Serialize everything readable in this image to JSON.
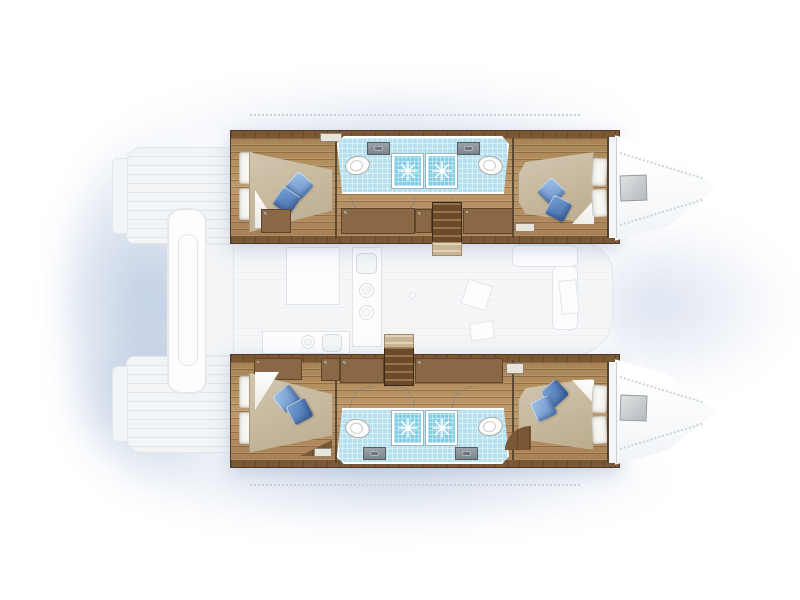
{
  "title": "Catamaran floor plan — top view, 4-cabin / 4-bathroom layout",
  "boat": {
    "type": "sailing catamaran deck & cabin plan",
    "orientation": {
      "bow": "right",
      "stern": "left",
      "port_hull": "top",
      "starboard_hull": "bottom"
    }
  },
  "palette": {
    "wood": "#b2895c",
    "wood_dark": "#7a5836",
    "bath_floor": "#b7e0ee",
    "shower": "#84cde3",
    "fixture_white": "#fbfbf9",
    "mattress_beige": "#c7b89d",
    "cushion_blue_light": "#6a93cb",
    "cushion_blue_dark": "#4772b0",
    "ghost_gray": "#f2f4f6",
    "shadow_blue": "#9fb4d4",
    "hatch_gray": "#c3c7c9"
  },
  "hulls": [
    {
      "name": "port hull (top)",
      "rooms": [
        {
          "name": "aft double cabin",
          "items": [
            "double bed",
            "2 white pillows",
            "blue cushion light",
            "blue cushion dark",
            "locker"
          ]
        },
        {
          "name": "aft bathroom",
          "items": [
            "washbasin",
            "toilet",
            "shower"
          ]
        },
        {
          "name": "forward bathroom",
          "items": [
            "shower",
            "washbasin",
            "toilet"
          ]
        },
        {
          "name": "forward double cabin",
          "items": [
            "double bed",
            "2 white pillows",
            "blue cushion light",
            "blue cushion dark"
          ]
        },
        {
          "name": "bow locker",
          "items": [
            "deck hatch"
          ]
        }
      ],
      "features": [
        "companionway stairs",
        "hanging lockers",
        "door swing arcs",
        "vents"
      ]
    },
    {
      "name": "starboard hull (bottom)",
      "rooms": [
        {
          "name": "aft double cabin",
          "items": [
            "double bed",
            "2 white pillows",
            "blue cushion light",
            "blue cushion dark",
            "bench"
          ]
        },
        {
          "name": "aft bathroom",
          "items": [
            "toilet",
            "washbasin",
            "shower"
          ]
        },
        {
          "name": "forward bathroom",
          "items": [
            "shower",
            "toilet",
            "washbasin"
          ]
        },
        {
          "name": "forward double cabin",
          "items": [
            "double bed",
            "2 white pillows",
            "blue cushion light",
            "blue cushion dark",
            "step platform"
          ]
        },
        {
          "name": "bow locker",
          "items": [
            "deck hatch"
          ]
        }
      ],
      "features": [
        "companionway stairs",
        "hanging lockers",
        "drawer unit",
        "door swing arcs",
        "vents"
      ]
    }
  ],
  "deck_ghost": {
    "features": [
      "aft swim platforms",
      "transom steps",
      "dinghy on davit platform",
      "bridgedeck",
      "saloon",
      "galley counter with sink and two burners",
      "aft galley counter with sink and burner",
      "dining sofa",
      "saloon table",
      "lounge cushions",
      "mast foot",
      "side deck lifelines",
      "deck hatches"
    ]
  },
  "icons": {
    "shower-spray-icon": "white starburst in shower tray",
    "hanger-icon": "vertical strokes in locker cells",
    "door-swing-icon": "dashed quarter-circle arc",
    "vent-icon": "three dark slots",
    "hatch-icon": "gray gradient square"
  },
  "counts": {
    "cabins": 4,
    "beds": 4,
    "bathrooms": 4,
    "showers": 4,
    "toilets": 4,
    "washbasins": 4,
    "stairs": 2,
    "bow_hatches": 2
  }
}
